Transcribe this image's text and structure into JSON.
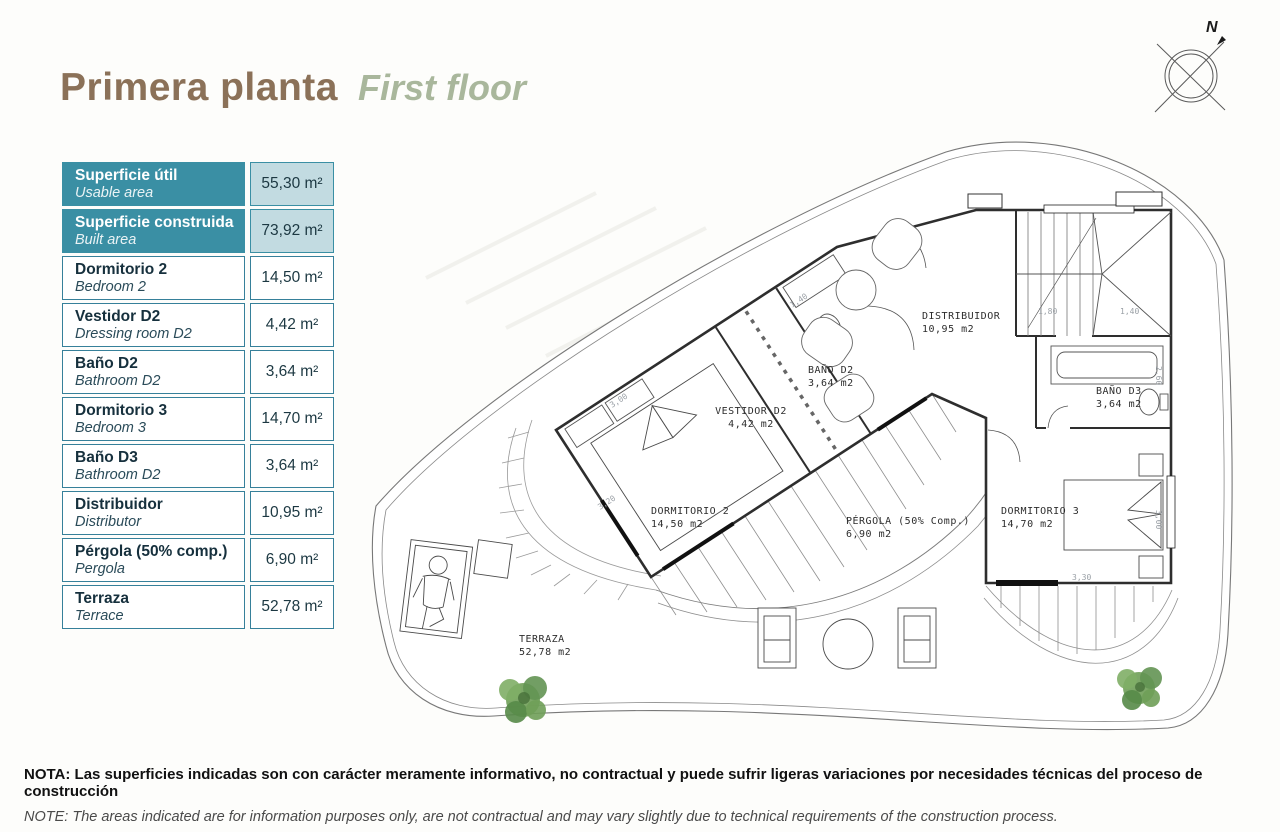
{
  "header": {
    "title_es": "Primera planta",
    "title_en": "First floor"
  },
  "compass": {
    "label": "N"
  },
  "areas_table": {
    "rows": [
      {
        "label": "Superficie útil",
        "sub": "Usable area",
        "value": "55,30 m²"
      },
      {
        "label": "Superficie construida",
        "sub": "Built area",
        "value": "73,92 m²"
      },
      {
        "label": "Dormitorio 2",
        "sub": "Bedroom 2",
        "value": "14,50 m²"
      },
      {
        "label": "Vestidor D2",
        "sub": "Dressing room D2",
        "value": "4,42 m²"
      },
      {
        "label": "Baño D2",
        "sub": "Bathroom D2",
        "value": "3,64 m²"
      },
      {
        "label": "Dormitorio 3",
        "sub": "Bedroom 3",
        "value": "14,70 m²"
      },
      {
        "label": "Baño D3",
        "sub": "Bathroom D2",
        "value": "3,64 m²"
      },
      {
        "label": "Distribuidor",
        "sub": "Distributor",
        "value": "10,95 m²"
      },
      {
        "label": "Pérgola (50% comp.)",
        "sub": "Pergola",
        "value": "6,90 m²"
      },
      {
        "label": "Terraza",
        "sub": "Terrace",
        "value": "52,78 m²"
      }
    ]
  },
  "plan": {
    "rooms": [
      {
        "name": "DORMITORIO 2",
        "area": "14,50 m2"
      },
      {
        "name": "VESTIDOR D2",
        "area": "4,42 m2"
      },
      {
        "name": "BAÑO D2",
        "area": "3,64 m2"
      },
      {
        "name": "DISTRIBUIDOR",
        "area": "10,95 m2"
      },
      {
        "name": "BAÑO D3",
        "area": "3,64 m2"
      },
      {
        "name": "DORMITORIO 3",
        "area": "14,70 m2"
      },
      {
        "name": "PÉRGOLA (50% Comp.)",
        "area": "6,90 m2"
      },
      {
        "name": "TERRAZA",
        "area": "52,78 m2"
      }
    ],
    "dims": [
      "1,40",
      "1,80",
      "1,40",
      "2,60",
      "3,30",
      "3,00",
      "3,00",
      "3,20"
    ]
  },
  "notes": {
    "es": "NOTA: Las superficies indicadas son con carácter meramente informativo, no contractual y puede sufrir ligeras variaciones por necesidades técnicas del proceso de construcción",
    "en": "NOTE: The areas indicated are for information purposes only, are not contractual and may vary slightly due to technical requirements of the construction process."
  },
  "colors": {
    "teal": "#3a8fa4",
    "teal_light": "#c2dbe1",
    "title_brown": "#8b7158",
    "title_sage": "#a9b79c",
    "wall": "#2e2e2e",
    "tree_green": "#6f9e58"
  }
}
